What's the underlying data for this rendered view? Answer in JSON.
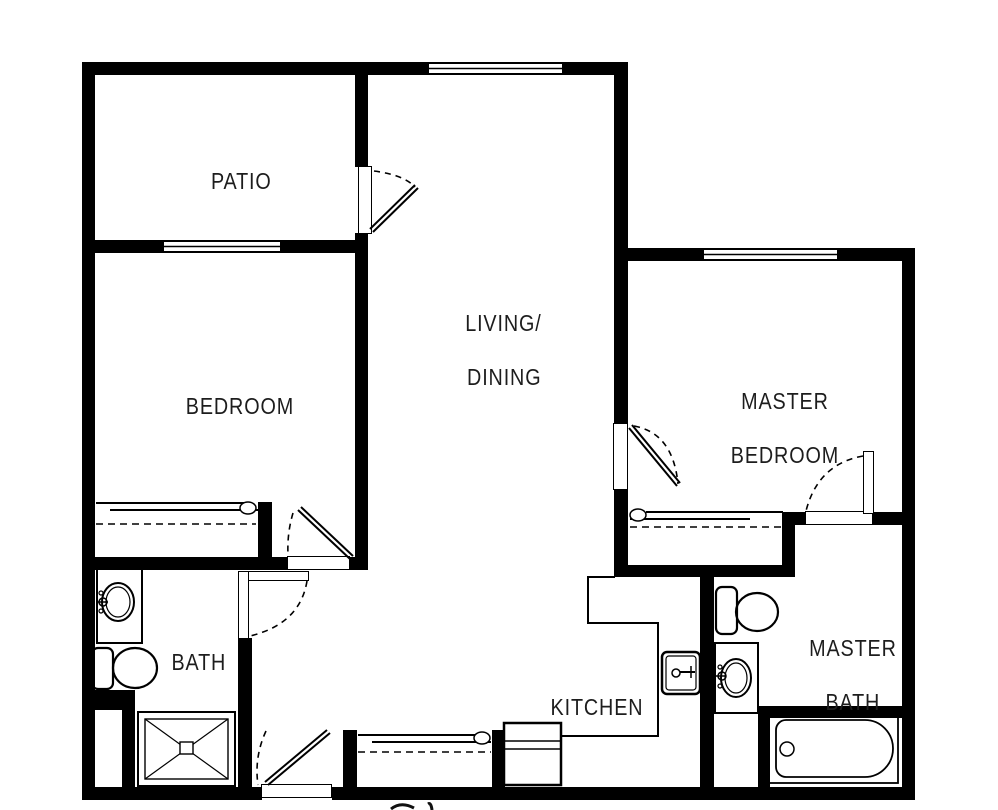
{
  "plan": {
    "rooms": {
      "patio": {
        "label": "PATIO"
      },
      "living_dining": {
        "line1": "LIVING/",
        "line2": "DINING"
      },
      "bedroom": {
        "label": "BEDROOM"
      },
      "master_bedroom": {
        "line1": "MASTER",
        "line2": "BEDROOM"
      },
      "bath": {
        "label": "BATH"
      },
      "kitchen": {
        "label": "KITCHEN"
      },
      "master_bath": {
        "line1": "MASTER",
        "line2": "BATH"
      }
    },
    "fixtures": [
      "toilet",
      "vanity-sink",
      "shower",
      "bathtub",
      "kitchen-sink",
      "sliding-closet-door",
      "closet-rod",
      "hinged-door",
      "window",
      "utility-closet"
    ],
    "colors": {
      "wall": "#000000",
      "floor": "#ffffff",
      "line": "#1c1c1c"
    }
  }
}
